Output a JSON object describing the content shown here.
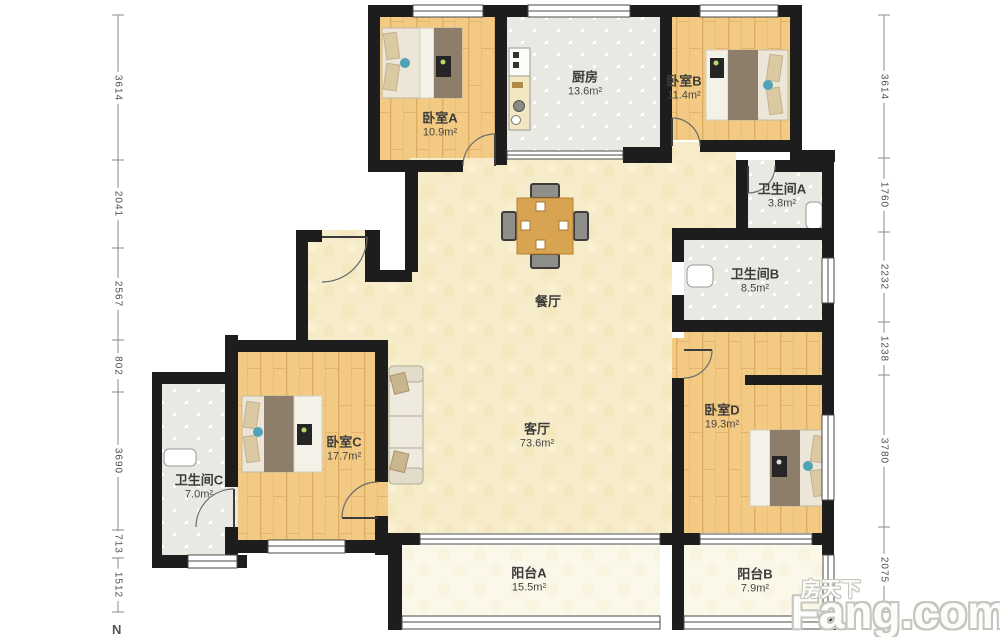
{
  "rooms": [
    {
      "id": "bedroom-a",
      "name": "卧室A",
      "area": "10.9m²"
    },
    {
      "id": "kitchen",
      "name": "厨房",
      "area": "13.6m²"
    },
    {
      "id": "bedroom-b",
      "name": "卧室B",
      "area": "11.4m²"
    },
    {
      "id": "bathroom-a",
      "name": "卫生间A",
      "area": "3.8m²"
    },
    {
      "id": "bathroom-b",
      "name": "卫生间B",
      "area": "8.5m²"
    },
    {
      "id": "dining-room",
      "name": "餐厅",
      "area": ""
    },
    {
      "id": "living-room",
      "name": "客厅",
      "area": "73.6m²"
    },
    {
      "id": "bedroom-c",
      "name": "卧室C",
      "area": "17.7m²"
    },
    {
      "id": "bathroom-c",
      "name": "卫生间C",
      "area": "7.0m²"
    },
    {
      "id": "bedroom-d",
      "name": "卧室D",
      "area": "19.3m²"
    },
    {
      "id": "balcony-a",
      "name": "阳台A",
      "area": "15.5m²"
    },
    {
      "id": "balcony-b",
      "name": "阳台B",
      "area": "7.9m²"
    }
  ],
  "dimensions": {
    "left": [
      "3614",
      "2041",
      "2567",
      "802",
      "3690",
      "713",
      "1512"
    ],
    "right": [
      "3614",
      "1760",
      "2232",
      "1238",
      "3780",
      "2075"
    ]
  },
  "compass": "N",
  "watermark": {
    "cn": "房天下",
    "en": "Fang.com"
  },
  "colors": {
    "wall": "#1d1d1d",
    "wood_floor": "#f2ca83",
    "hall_floor": "#f6ecc9",
    "tile_floor": "#e9e9e4",
    "balcony_floor": "#fbf8e9",
    "accent_teal": "#4fa3b5"
  }
}
